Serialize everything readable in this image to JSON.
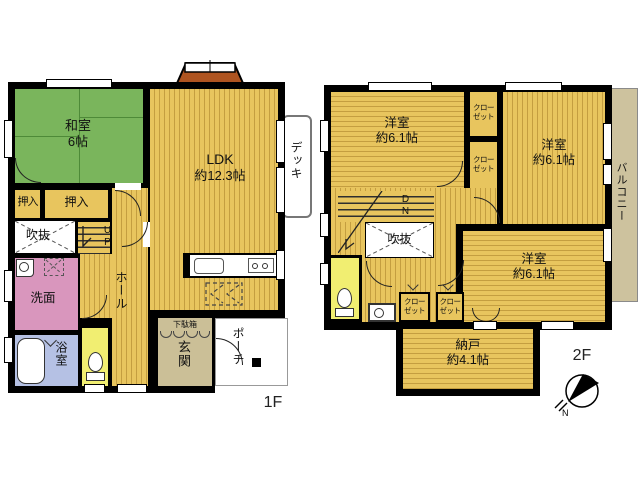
{
  "colors": {
    "wall": "#000000",
    "floor_yellow": "#E8C55E",
    "floor_stripe": "#C49E40",
    "tatami_green": "#7AB55C",
    "washroom_pink": "#D996BD",
    "bath_blue": "#B5C1E4",
    "toilet_yellow": "#F1EE71",
    "entry_tan": "#CBBF97",
    "balcony_tan": "#CDC29E",
    "bay_window_orange": "#AF5420"
  },
  "floor1": {
    "floor_label": "1F",
    "washitsu_name": "和室",
    "washitsu_size": "6帖",
    "ldk_name": "LDK",
    "ldk_size": "約12.3帖",
    "deck": "デッキ",
    "oshiire_left": "押入",
    "oshiire_right": "押入",
    "void": "吹抜",
    "stairs_up": "UP",
    "hall": "ホール",
    "washroom": "洗面",
    "bathroom": "浴室",
    "shoe_cabinet": "下駄箱",
    "entrance": "玄関",
    "porch": "ポーチ"
  },
  "floor2": {
    "floor_label": "2F",
    "bedroom_nw_name": "洋室",
    "bedroom_nw_size": "約6.1帖",
    "bedroom_ne_name": "洋室",
    "bedroom_ne_size": "約6.1帖",
    "bedroom_se_name": "洋室",
    "bedroom_se_size": "約6.1帖",
    "closet_line1": "クロー",
    "closet_line2": "ゼット",
    "void": "吹抜",
    "stairs_down": "DN",
    "storage_name": "納戸",
    "storage_size": "約4.1帖",
    "balcony": "バルコニー",
    "compass_north": "N"
  }
}
